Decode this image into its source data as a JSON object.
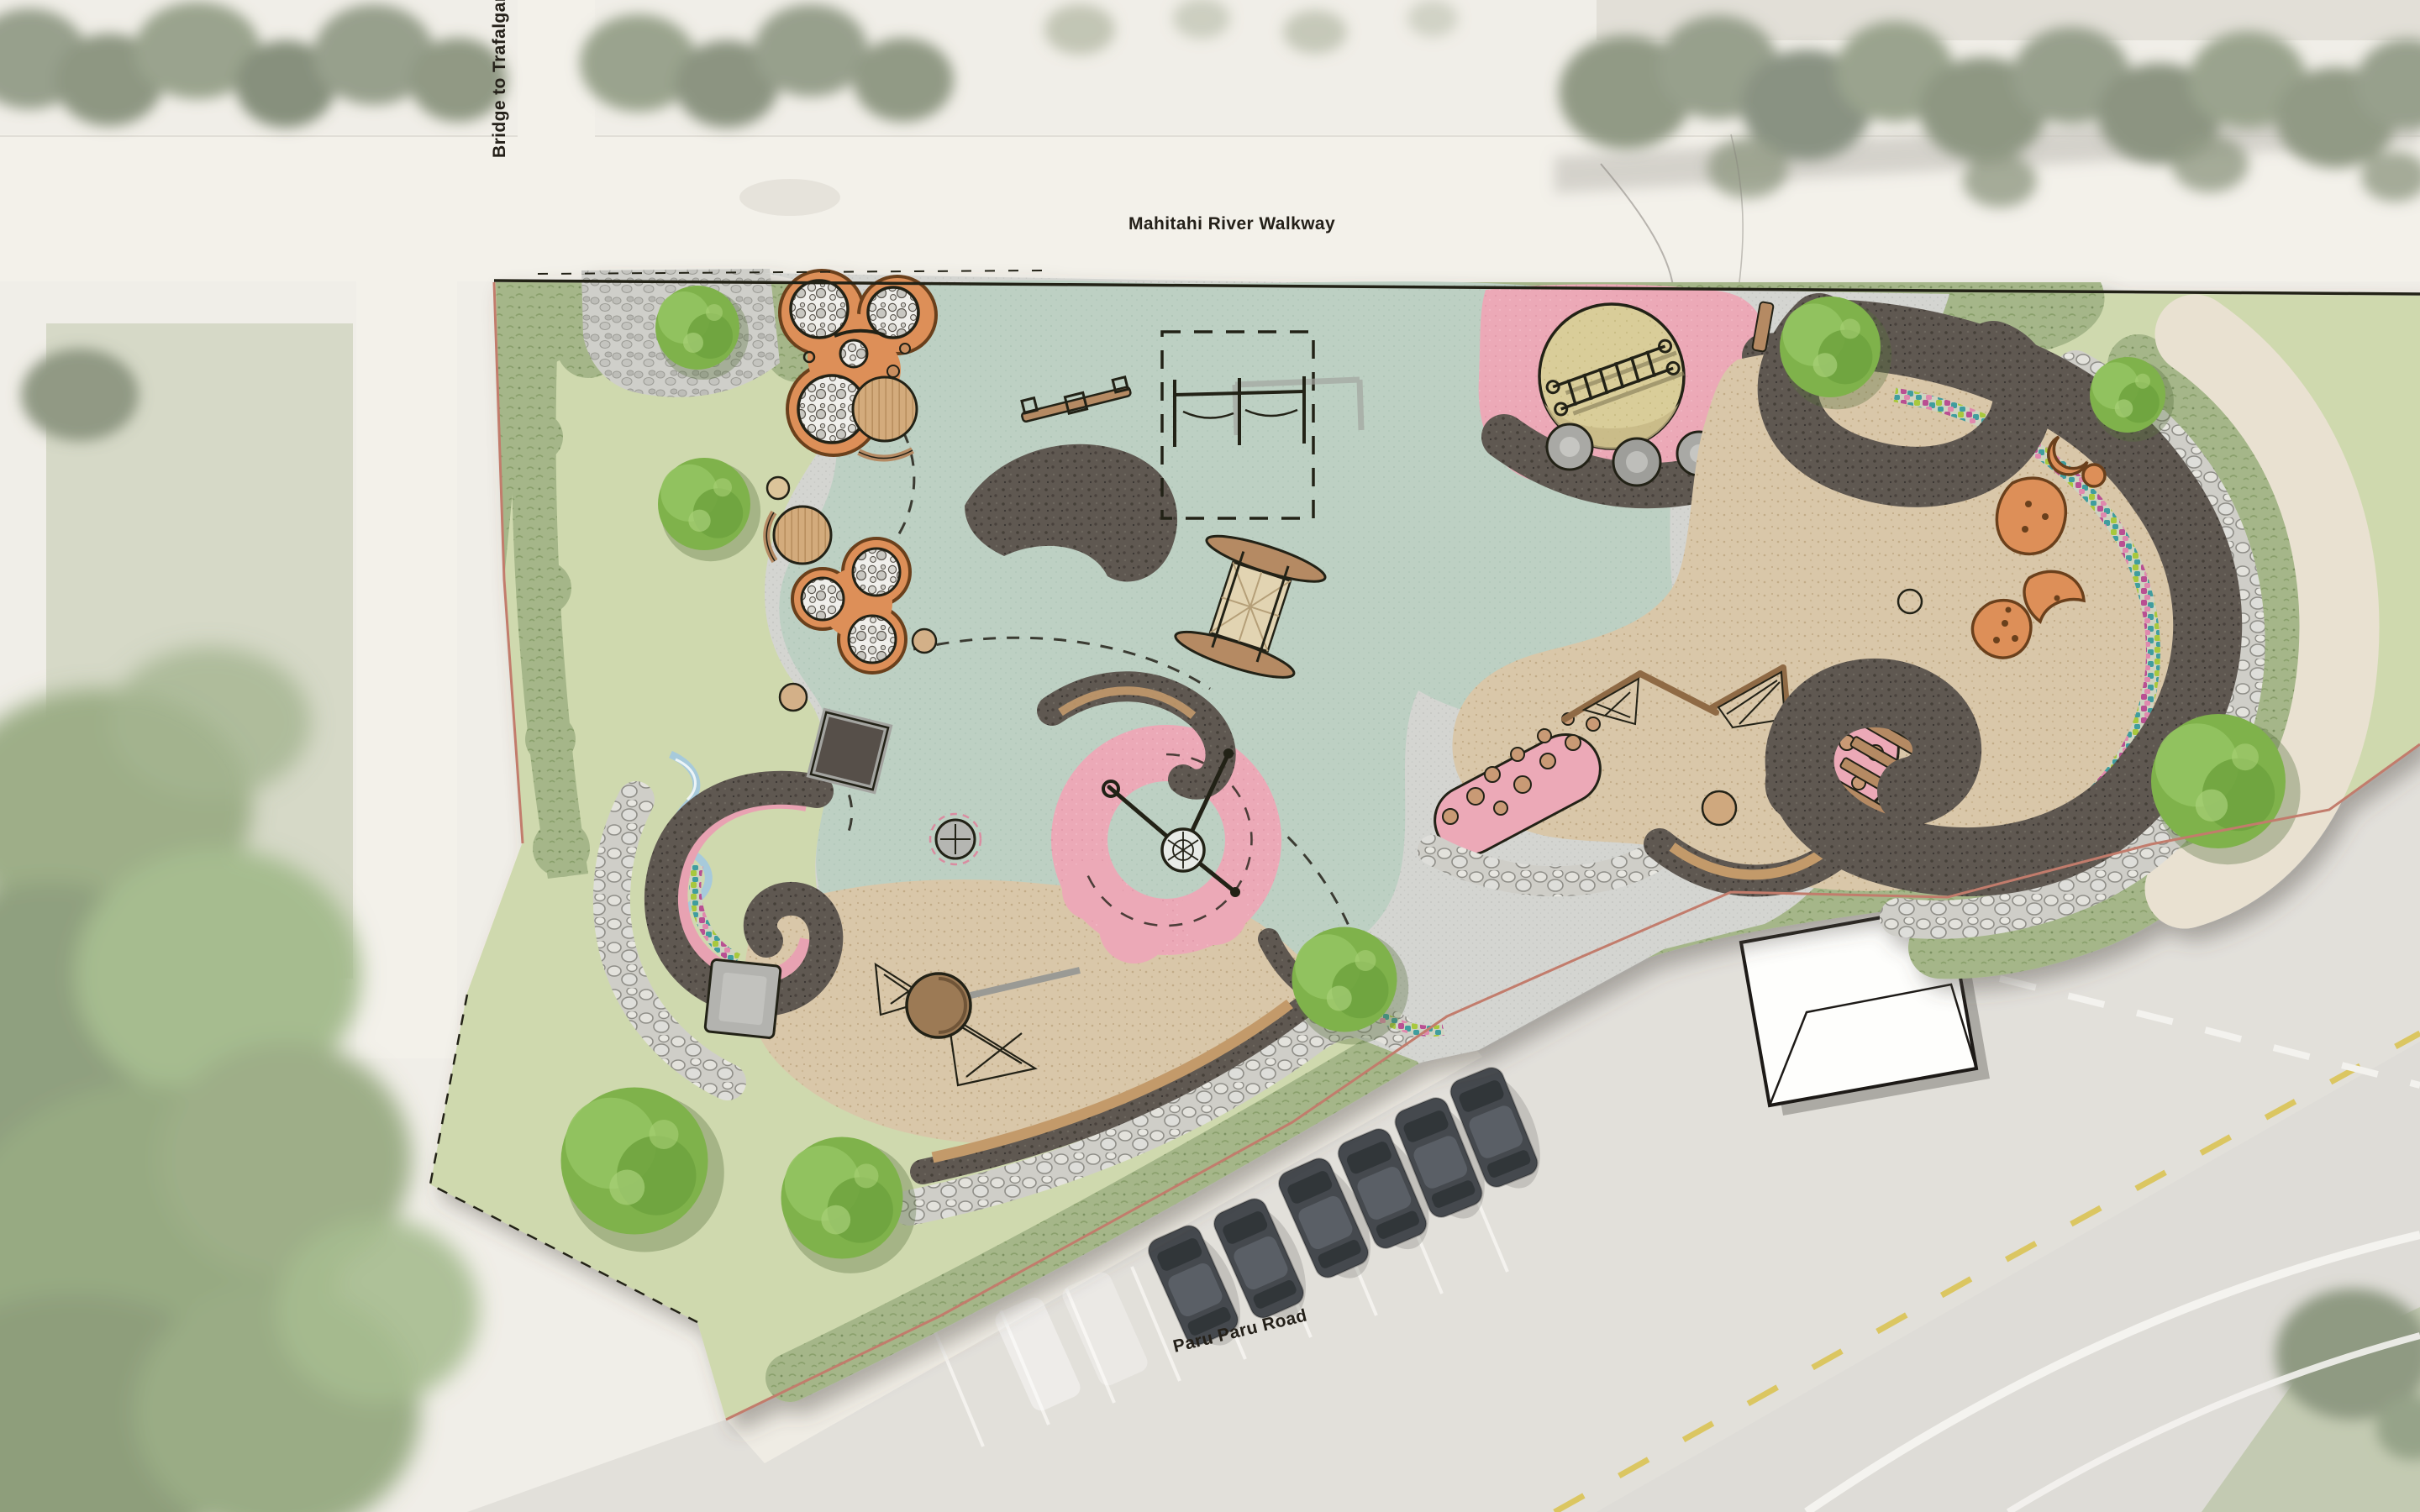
{
  "meta": {
    "kind": "playground-landscape-plan-over-aerial-photo"
  },
  "labels": {
    "bridge_path": "Bridge to Trafalgar Park",
    "river_walkway": "Mahitahi River Walkway",
    "road": "Paru Paru Road"
  },
  "palette": {
    "paper": "#efede6",
    "walk": "#f3f1ea",
    "road": "#d9d7d2",
    "lawn": "#cfd9ae",
    "planting": "#a5b689",
    "teal": "#bdd0c3",
    "pink": "#eca9b7",
    "bark": "#d9c7a9",
    "berm": "#5f5851",
    "concrete": "#d4d5d1",
    "cobble": "#cfcfca",
    "orange": "#dd8f58",
    "timber": "#b58a64",
    "boulder": "#d8d7d1",
    "water": "#a7cadb",
    "hill": "#d9cd99",
    "cream": "#e9e1d1",
    "ink": "#242019",
    "treeGreen": "#7fb24b",
    "aerialTree": "#66755a",
    "yellowDash": "#d9c24b",
    "boundaryRed": "#c27b6c",
    "building": "#fefefc",
    "mosaic1": "#b94f92",
    "mosaic2": "#3f9d9e",
    "mosaic3": "#a8c83e",
    "mosaic4": "#e089ae"
  },
  "site": {
    "zones": [
      "perimeter planting",
      "lawn",
      "cobble entry paving",
      "concrete paving",
      "teal rubber softfall",
      "pink rubber softfall",
      "bark mulch",
      "cream path",
      "boulder edging",
      "mosaic band",
      "dark koru berm"
    ],
    "equipment": [
      "orange trefoil climber (upper)",
      "orange trefoil climber (lower)",
      "timber deck circles with benches",
      "seesaw",
      "swing set",
      "waka play structure",
      "slide mound",
      "in-ground trampoline",
      "spinner",
      "basket swing on pink koru",
      "left koru with mosaic",
      "grey platform",
      "water play channel",
      "climbing hill with ladder net",
      "stepping pods",
      "giant koru berm",
      "orange climbing boulders",
      "A-frame net climber",
      "twist net climber",
      "timber stairs",
      "pink stepping blobs"
    ],
    "trees": {
      "plan_trees": 8,
      "aerial_tree_clusters": 3
    },
    "parking": {
      "bay_count": 8,
      "cars": [
        {
          "color": "dark grey"
        },
        {
          "color": "dark grey"
        },
        {
          "color": "white van"
        },
        {
          "color": "silver"
        },
        {
          "color": "white"
        },
        {
          "color": "white"
        }
      ]
    },
    "building": {
      "type": "white gable-roof building"
    }
  }
}
